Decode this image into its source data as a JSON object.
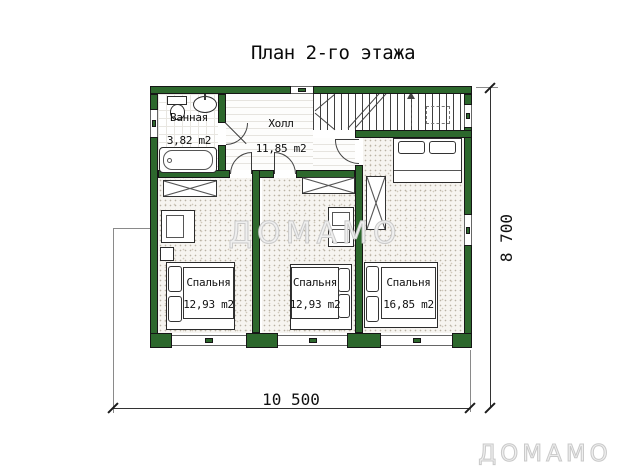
{
  "title": "План 2-го этажа",
  "rooms": {
    "bathroom": {
      "name": "Ванная",
      "area": "3,82 m2"
    },
    "hall": {
      "name": "Холл",
      "area": "11,85 m2"
    },
    "bedroom_left": {
      "name": "Спальня",
      "area": "12,93 m2"
    },
    "bedroom_middle": {
      "name": "Спальня",
      "area": "12,93 m2"
    },
    "bedroom_right": {
      "name": "Спальня",
      "area": "16,85 m2"
    }
  },
  "dims": {
    "width": "10 500",
    "height": "8 700"
  },
  "watermarks": {
    "center": "ДОМАМО",
    "corner": "ДОМАМО"
  },
  "colors": {
    "wall_green": "#2d682d",
    "outline": "#161616",
    "watermark_gray": "#c9c9c9",
    "floor_dots": "#b9b2a4"
  }
}
